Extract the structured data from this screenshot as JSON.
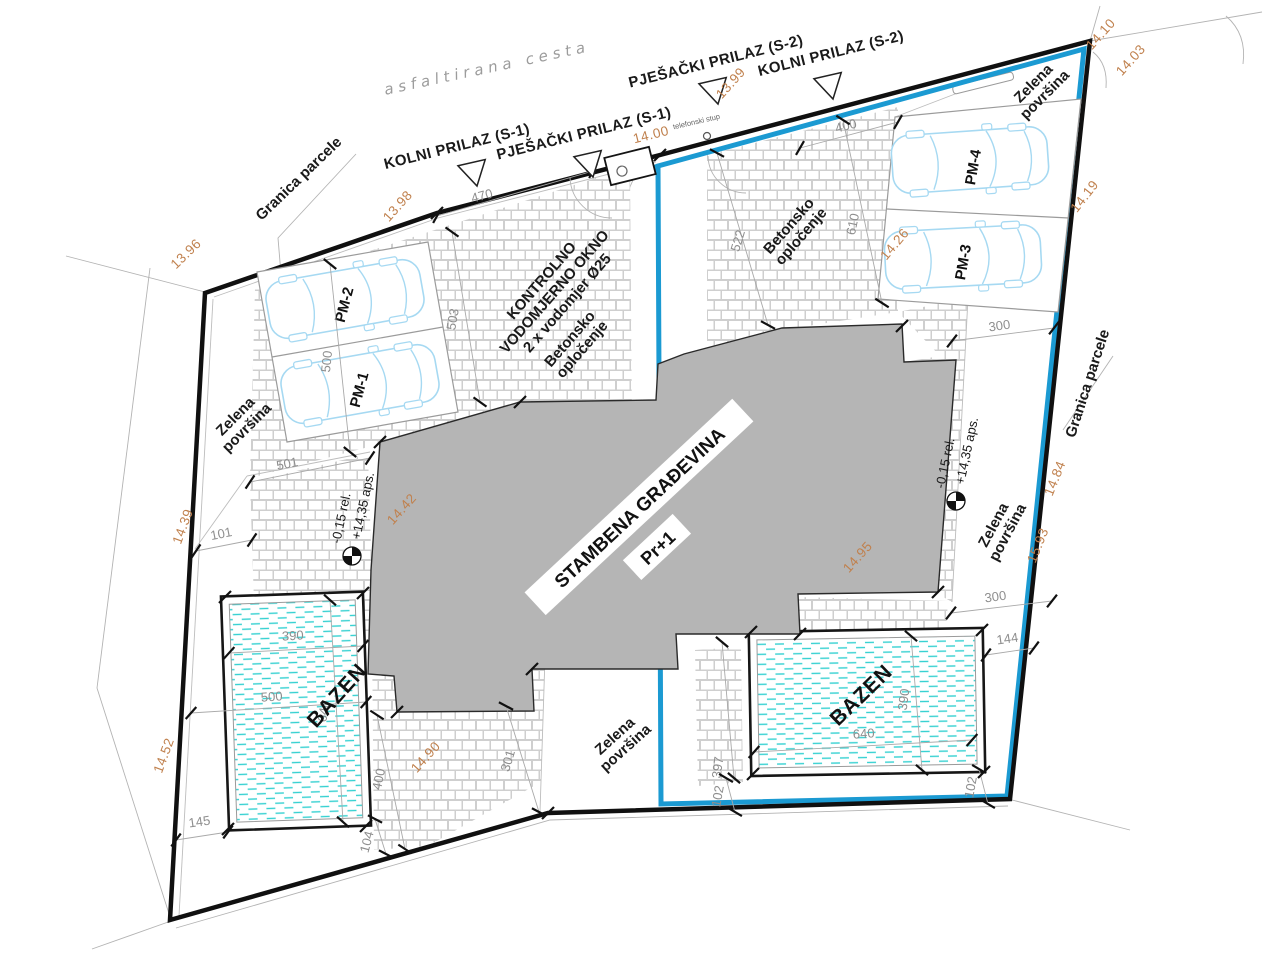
{
  "road": {
    "asphalt_road": "asfaltirana cesta",
    "kolni_prilaz_s1": "KOLNI PRILAZ (S-1)",
    "pjesacki_prilaz_s1": "PJEŠAČKI PRILAZ (S-1)",
    "pjesacki_prilaz_s2": "PJEŠAČKI PRILAZ (S-2)",
    "kolni_prilaz_s2": "KOLNI PRILAZ (S-2)",
    "telefonski_stup": "telefonski stup"
  },
  "parcel": {
    "granica_parcele": "Granica parcele",
    "zelena_line1": "Zelena",
    "zelena_line2": "površina",
    "betonsko_line1": "Betonsko",
    "betonsko_line2": "opločenje"
  },
  "building": {
    "name": "STAMBENA GRAĐEVINA",
    "floors": "Pr+1"
  },
  "pool": {
    "label": "BAZEN"
  },
  "parking": {
    "pm1": "PM-1",
    "pm2": "PM-2",
    "pm3": "PM-3",
    "pm4": "PM-4"
  },
  "water_meter": {
    "line1": "KONTROLNO",
    "line2": "VODOMJERNO OKNO",
    "line3": "2 x vodomjer Ø25"
  },
  "levels": {
    "relative": "-0,15 rel.",
    "absolute": "+14,35 aps."
  },
  "spot_heights": {
    "h1396": "13.96",
    "h1398": "13.98",
    "h1399": "13.99",
    "h1400": "14.00",
    "h1403": "14.03",
    "h1410": "14.10",
    "h1419": "14.19",
    "h1426": "14.26",
    "h1439": "14.39",
    "h1442": "14.42",
    "h1452": "14.52",
    "h1484": "14.84",
    "h1490": "14.90",
    "h1495": "14.95",
    "h1593": "15.93"
  },
  "dimensions": {
    "d470": "470",
    "d400_ne": "400",
    "d503": "503",
    "d500_parking": "500",
    "d501": "501",
    "d101": "101",
    "d522": "522",
    "d610": "610",
    "d300_e": "300",
    "d390_w": "390",
    "d500_w": "500",
    "d640_w": "640",
    "d145": "145",
    "d104": "104",
    "d400_sw": "400",
    "d301": "301",
    "d397": "397",
    "d102_a": "102",
    "d102_b": "102",
    "d144": "144",
    "d300_se": "300",
    "d390_e": "390",
    "d640_e": "640"
  },
  "colors": {
    "parcel_line": "#101010",
    "unit_boundary_blue": "#1b9ad2",
    "building_fill": "#b5b5b5",
    "water_dash": "#36d1d1",
    "spot_height_orange": "#c0814e",
    "car_outline": "#a6d9f2"
  }
}
